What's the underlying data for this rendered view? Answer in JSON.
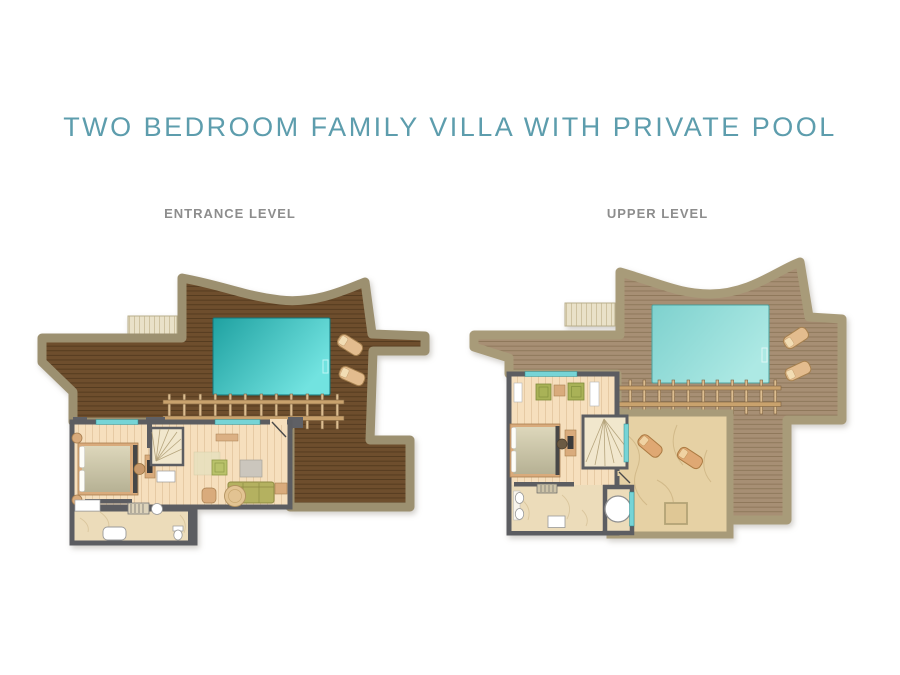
{
  "page": {
    "background_color": "#ffffff"
  },
  "title": {
    "text": "TWO BEDROOM FAMILY VILLA WITH PRIVATE POOL",
    "color": "#5d9dad"
  },
  "plan_label_color": "#8d8d8d",
  "plans": [
    {
      "id": "entrance-level",
      "label": "ENTRANCE LEVEL",
      "elements": [
        "entry-steps",
        "sun-deck",
        "private-pool",
        "pool-ladder",
        "pergola",
        "sun-loungers",
        "bedroom-bed",
        "nightstands",
        "desk-with-chair",
        "staircase",
        "living-sofa",
        "armchair",
        "dining-table",
        "green-pouf",
        "rug",
        "bathroom-tub",
        "shower",
        "sink",
        "toilet"
      ],
      "palette": {
        "deck_wood": "#6e4e2d",
        "deck_border": "#9c9070",
        "pool_gradient": [
          "#1fa1a1",
          "#72e3e0"
        ],
        "interior_floor": "#f6dfbd",
        "bathroom_marble": "#ecdcba",
        "walls": "#5c5d61",
        "windows": "#76d4d6",
        "furniture_olive": "#b4b160",
        "furniture_tan": "#d9ab7c"
      }
    },
    {
      "id": "upper-level",
      "label": "UPPER LEVEL",
      "elements": [
        "entry-steps",
        "roof-deck",
        "private-pool",
        "pergola",
        "sun-loungers",
        "stone-terrace",
        "terrace-loungers",
        "bedroom-bed",
        "sitting-chairs",
        "side-table",
        "desk-with-chair",
        "staircase",
        "round-bathtub",
        "double-sinks",
        "shower",
        "dresser"
      ],
      "palette": {
        "deck_wood": "#a78f74",
        "deck_border": "#a89b79",
        "pool_gradient": [
          "#7ed1ce",
          "#ade9e4"
        ],
        "terrace_stone": "#e6d1a4",
        "interior_floor": "#f6dfbd",
        "bathroom_marble": "#ecdcba",
        "walls": "#5c5d61",
        "windows": "#76d4d6"
      }
    }
  ]
}
